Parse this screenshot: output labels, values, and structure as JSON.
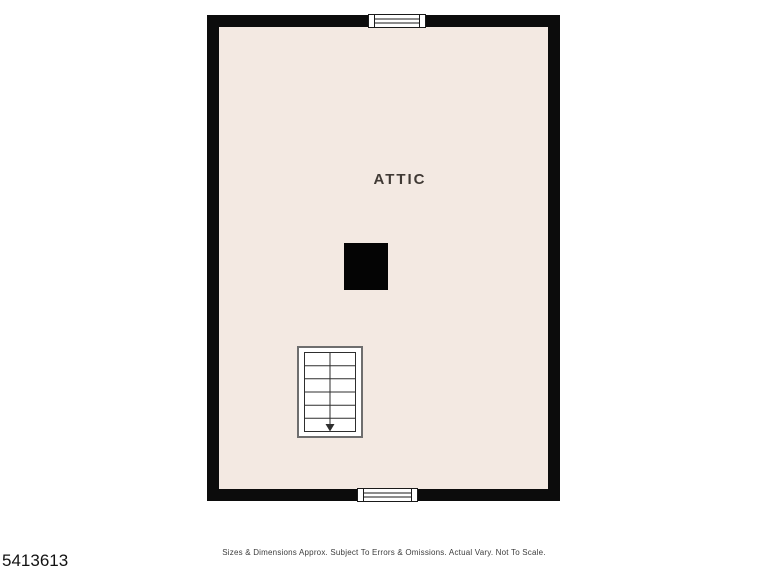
{
  "page": {
    "listing_id": "5413613",
    "disclaimer": "Sizes & Dimensions Approx. Subject To Errors & Omissions. Actual Vary. Not To Scale."
  },
  "floorplan": {
    "room_label": "ATTIC",
    "features": {
      "chimney": "solid black square flue",
      "staircase_direction": "down",
      "stair_step_count": 6,
      "windows": [
        "top-center",
        "bottom-center"
      ]
    }
  },
  "colors": {
    "background": "#ffffff",
    "wall": "#0c0c0c",
    "floor": "#f3e9e2",
    "chimney": "#040404",
    "stair_outline": "#6e6e6e",
    "stair_lines": "#2e2e2e",
    "label_text": "#403a35",
    "footer_text": "#3d3d3d",
    "id_text": "#121212"
  }
}
